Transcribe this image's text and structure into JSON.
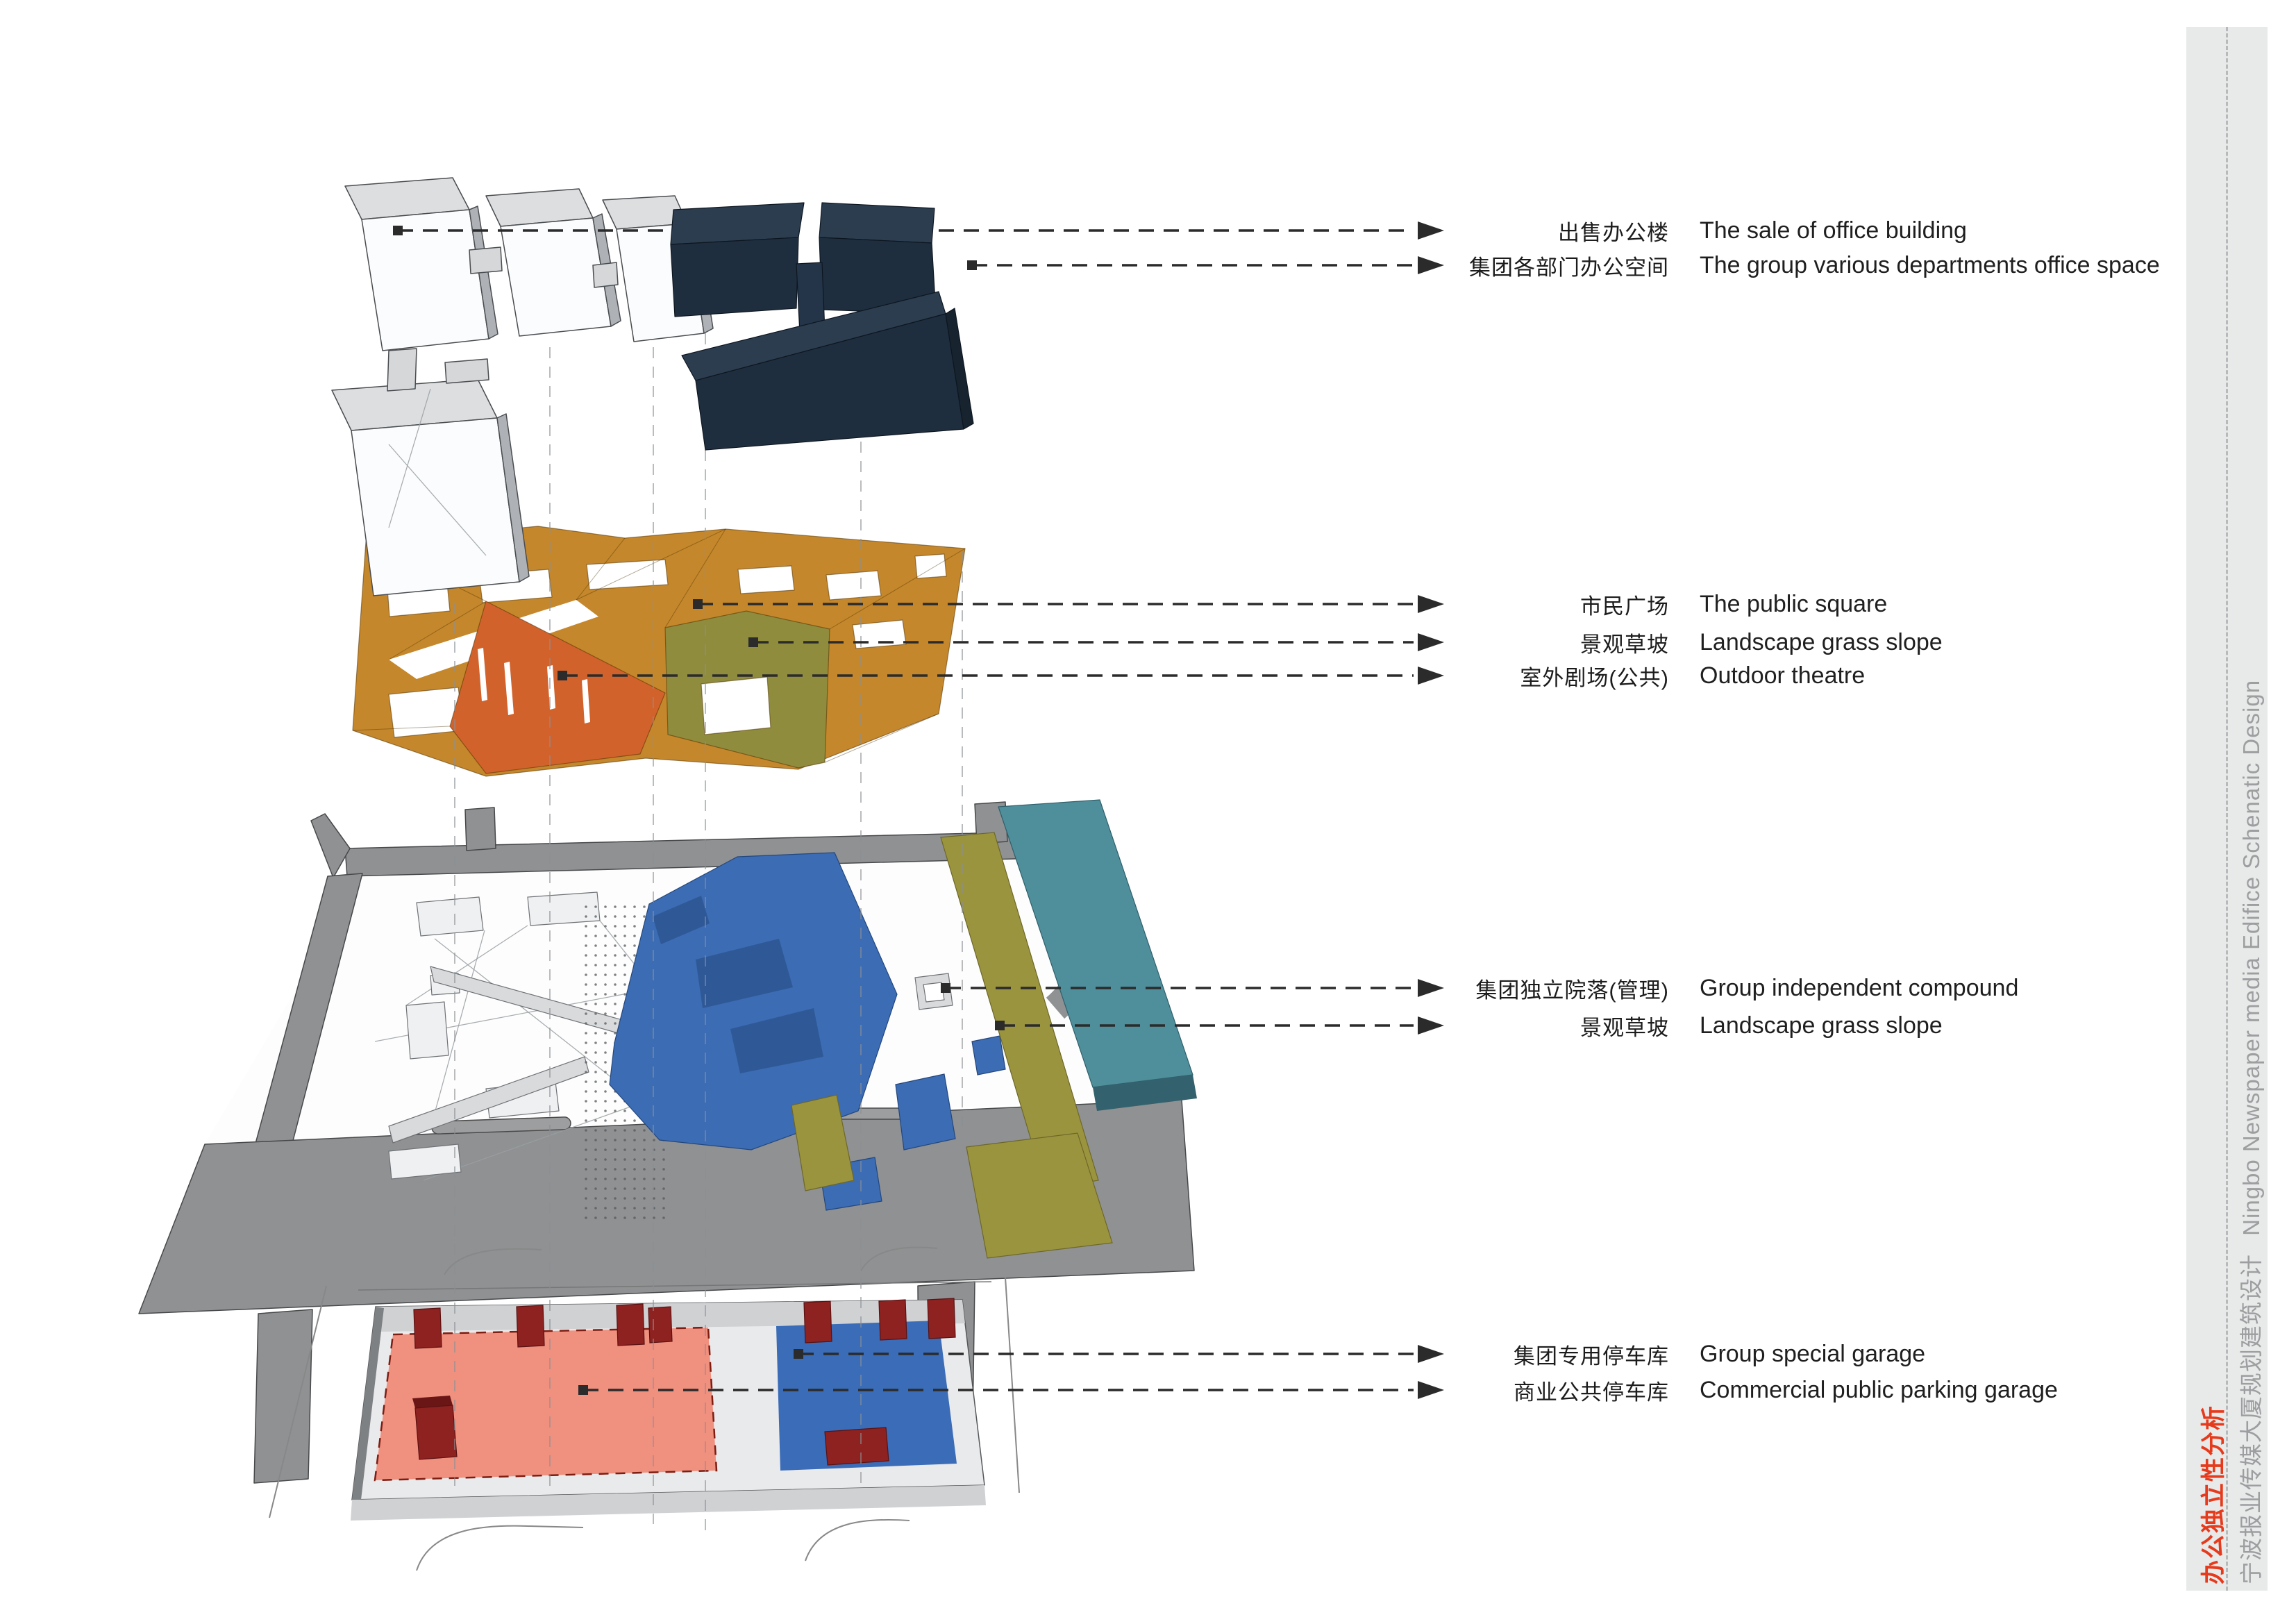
{
  "page": {
    "background": "#ffffff"
  },
  "sidebar": {
    "background": "#e8e9e9",
    "divider_style": "dashed",
    "title_cn": "办公独立性分析",
    "title_color": "#e63a1c",
    "subtitle_cn": "宁波报业传媒大厦规划建筑设计",
    "subtitle_en": "Ningbo Newspaper media Edifice Schenatic Design",
    "subtitle_color": "#9c9ea0"
  },
  "legend": {
    "arrow_color": "#2b2b2b",
    "rows": [
      {
        "cn": "出售办公楼",
        "en": "The sale of office building",
        "points_to": "white office towers",
        "color": "#fbfcfd"
      },
      {
        "cn": "集团各部门办公空间",
        "en": "The group various departments office space",
        "points_to": "navy office blocks",
        "color": "#1f2e3e"
      },
      {
        "cn": "市民广场",
        "en": "The public square",
        "points_to": "orange roof plaza",
        "color": "#c5872b"
      },
      {
        "cn": "景观草坡",
        "en": "Landscape grass slope",
        "points_to": "olive roof slope",
        "color": "#8f8c3e"
      },
      {
        "cn": "室外剧场(公共)",
        "en": "Outdoor theatre",
        "points_to": "red-orange theatre wedge",
        "color": "#d2622c"
      },
      {
        "cn": "集团独立院落(管理)",
        "en": "Group independent compound",
        "points_to": "courtyard on site plan",
        "color": "#3c6cb4"
      },
      {
        "cn": "景观草坡",
        "en": "Landscape grass slope",
        "points_to": "olive strip on site plan",
        "color": "#9b943e"
      },
      {
        "cn": "集团专用停车库",
        "en": "Group special garage",
        "points_to": "blue parking zone",
        "color": "#3a6cb8"
      },
      {
        "cn": "商业公共停车库",
        "en": "Commercial public parking garage",
        "points_to": "pink parking zone",
        "color": "#f0907f"
      }
    ]
  },
  "colors": {
    "navy": "#1f2e3e",
    "navy_top": "#2c3d50",
    "navy_side": "#17232f",
    "white_building": "#fbfcfd",
    "building_top": "#dcdee0",
    "building_side": "#aeb2b6",
    "roof_orange": "#c5872b",
    "theatre_red": "#d2622c",
    "grass_olive_roof": "#8f8c3e",
    "road_gray": "#8f9193",
    "plaza_blue": "#3c6cb4",
    "grass_olive_site": "#9b943e",
    "band_teal": "#4f8f9c",
    "parking_pink": "#f0907f",
    "parking_blue": "#3a6cb8",
    "stair_core_red": "#8e2220",
    "leader_line": "#2b2b2b",
    "construction_line": "#8c9094"
  }
}
